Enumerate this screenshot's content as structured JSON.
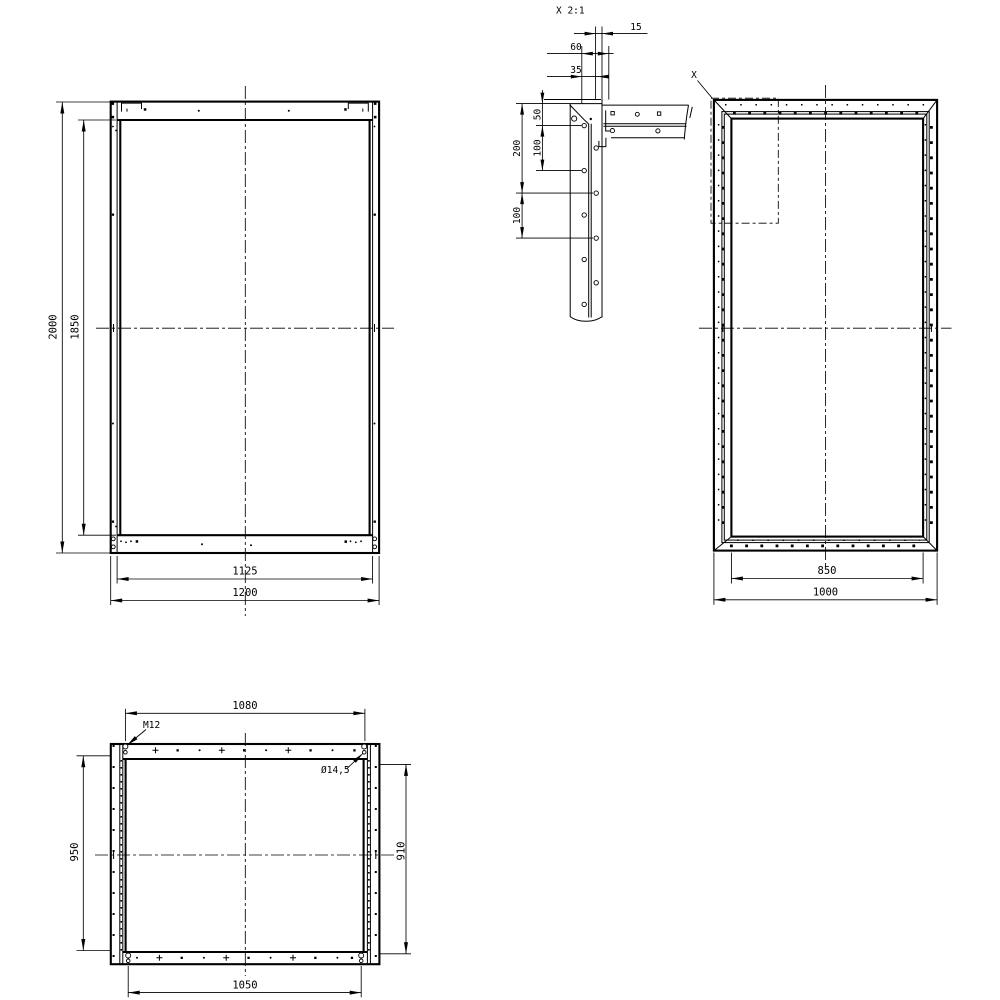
{
  "canvas": {
    "background": "#ffffff",
    "line_color": "#000000"
  },
  "front_view": {
    "dim_outer_height": "2000",
    "dim_inner_height": "1850",
    "dim_inner_width": "1125",
    "dim_outer_width": "1200"
  },
  "detail_view": {
    "title": "X  2:1",
    "dim_top_small": "15",
    "dim_top_large": "60",
    "dim_top_mid": "35",
    "dim_50": "50",
    "dim_100_upper": "100",
    "dim_200": "200",
    "dim_100_lower": "100"
  },
  "side_view": {
    "detail_label": "X",
    "dim_inner_width": "850",
    "dim_outer_width": "1000"
  },
  "plan_view": {
    "dim_hole_span_top": "1080",
    "thread_label": "M12",
    "hole_label": "Ø14,5",
    "dim_height_left": "950",
    "dim_height_right": "910",
    "dim_hole_span_bottom": "1050"
  }
}
